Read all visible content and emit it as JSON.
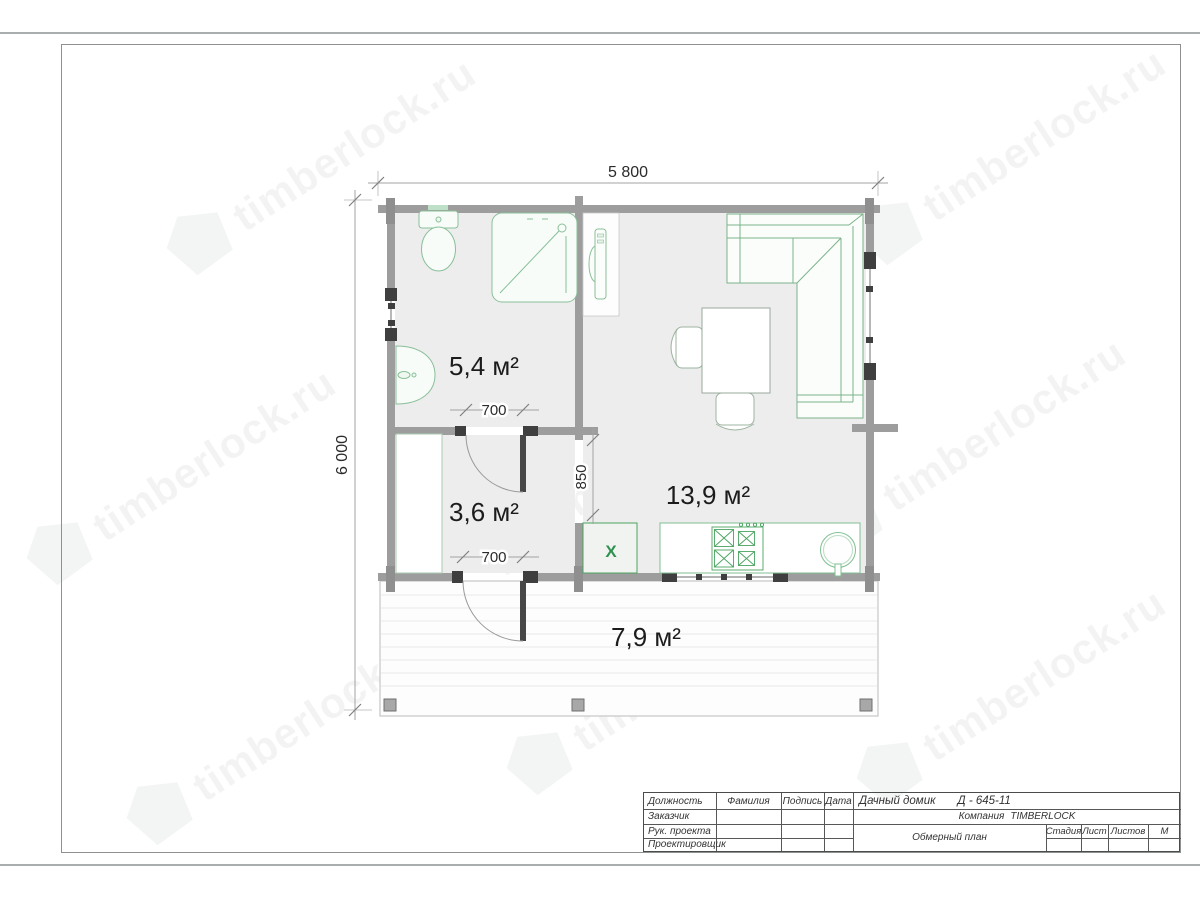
{
  "watermark": {
    "text": "timberlock.ru"
  },
  "plan": {
    "dimensions": {
      "overall_width": "5 800",
      "overall_height": "6 000",
      "bath_door_width": "700",
      "terrace_door_width": "700",
      "kitchen_opening": "850"
    },
    "areas": {
      "bathroom": "5,4 м²",
      "hallway": "3,6 м²",
      "living": "13,9 м²",
      "terrace": "7,9 м²"
    },
    "appliance_mark": "X"
  },
  "title_block": {
    "rows": [
      "Должность",
      "Заказчик",
      "Рук. проекта",
      "Проектировщик"
    ],
    "cols": [
      "Фамилия",
      "Подпись",
      "Дата"
    ],
    "project_title": "Дачный домик",
    "project_code": "Д - 645-11",
    "company_label": "Компания",
    "company_name": "TIMBERLOCK",
    "drawing_name": "Обмерный план",
    "stage_label": "Стадия",
    "sheet_label": "Лист",
    "sheets_label": "Листов",
    "scale_label": "М"
  }
}
